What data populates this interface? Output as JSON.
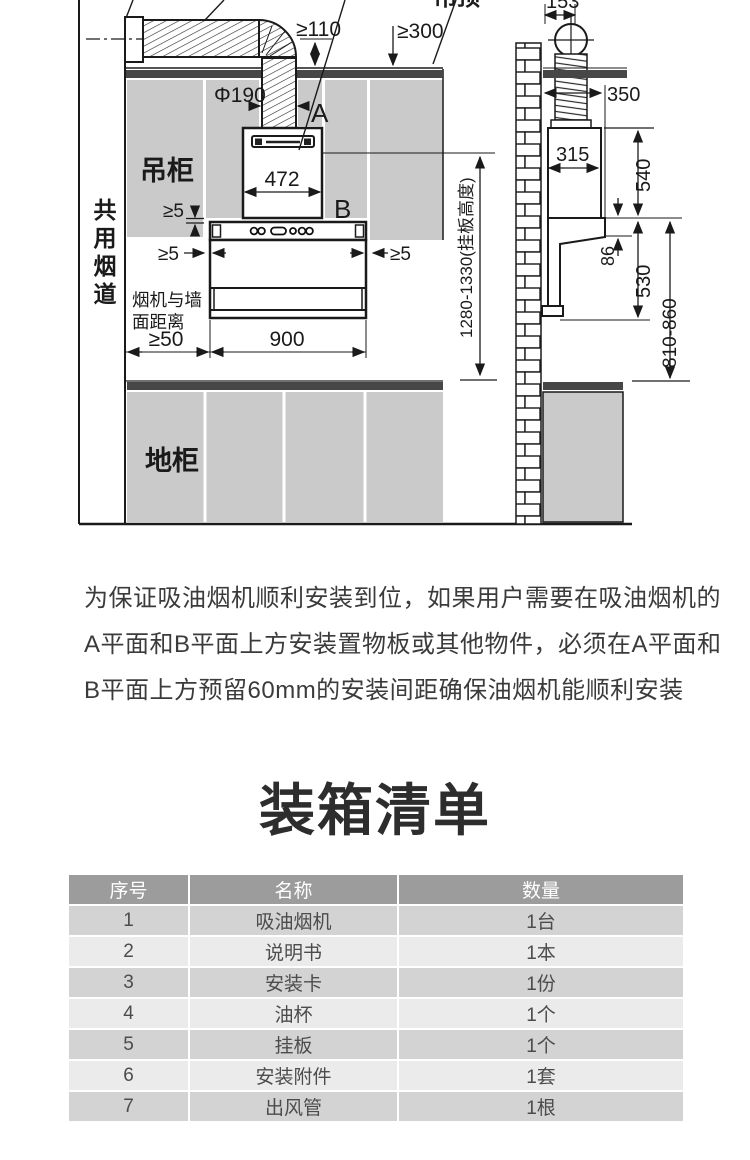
{
  "diagram": {
    "front": {
      "labels": {
        "ceiling": "吊顶",
        "hanging_cabinet": "吊柜",
        "floor_cabinet": "地柜",
        "shared_flue": "共用烟道",
        "wall_distance_line1": "烟机与墙",
        "wall_distance_line2": "面距离",
        "face_a": "A",
        "face_b": "B"
      },
      "dims": {
        "d110": "≥110",
        "d300": "≥300",
        "d190": "Φ190",
        "d472": "472",
        "d5_top": "≥5",
        "d5_left": "≥5",
        "d5_right": "≥5",
        "d50": "≥50",
        "d900": "900",
        "hang_height": "1280-1330(挂板高度)"
      }
    },
    "side": {
      "dims": {
        "d153": "153",
        "d350": "350",
        "d315": "315",
        "d540": "540",
        "d86": "86",
        "d530": "530",
        "d810": "810-860"
      }
    }
  },
  "note": {
    "line1": "为保证吸油烟机顺利安装到位，如果用户需要在吸油烟机的",
    "line2": "A平面和B平面上方安装置物板或其他物件，必须在A平面和",
    "line3": "B平面上方预留60mm的安装间距确保油烟机能顺利安装"
  },
  "packing": {
    "title": "装箱清单",
    "headers": {
      "no": "序号",
      "name": "名称",
      "qty": "数量"
    },
    "rows": [
      {
        "no": "1",
        "name": "吸油烟机",
        "qty": "1台"
      },
      {
        "no": "2",
        "name": "说明书",
        "qty": "1本"
      },
      {
        "no": "3",
        "name": "安装卡",
        "qty": "1份"
      },
      {
        "no": "4",
        "name": "油杯",
        "qty": "1个"
      },
      {
        "no": "5",
        "name": "挂板",
        "qty": "1个"
      },
      {
        "no": "6",
        "name": "安装附件",
        "qty": "1套"
      },
      {
        "no": "7",
        "name": "出风管",
        "qty": "1根"
      }
    ]
  },
  "colors": {
    "cabinet_gray": "#cacaca",
    "dark_bar": "#474747",
    "line": "#1a1a1a",
    "table_header_bg": "#9c9c9c",
    "row_odd_bg": "#d3d3d3",
    "row_even_bg": "#ebebeb",
    "header_text": "#ffffff"
  }
}
